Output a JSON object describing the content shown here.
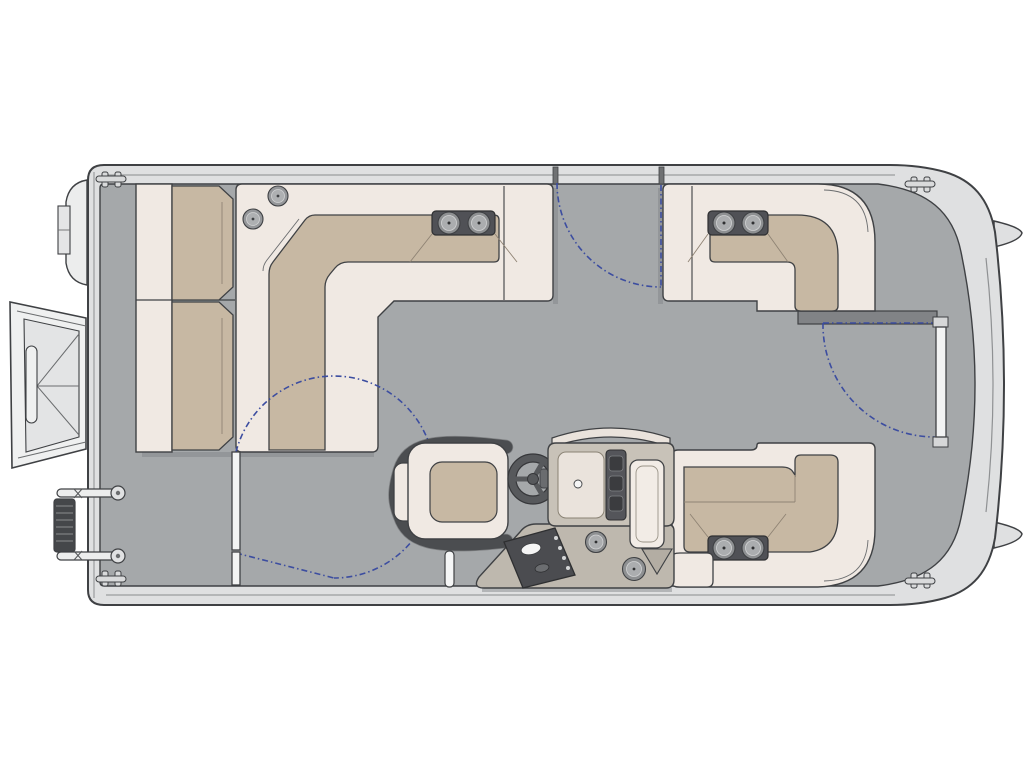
{
  "diagram": {
    "type": "pontoon-boat-floorplan",
    "view": "top-down",
    "orientation": "bow-right-stern-left",
    "components": [
      {
        "name": "hull",
        "label": "pontoon deck hull"
      },
      {
        "name": "stern-bench",
        "label": "stern bench seat, two cushions"
      },
      {
        "name": "port-stern-lounge",
        "label": "L-shaped lounge, port stern"
      },
      {
        "name": "port-bow-lounge",
        "label": "L-shaped lounge, port bow"
      },
      {
        "name": "starboard-bow-lounge",
        "label": "L-shaped chaise lounge, starboard bow"
      },
      {
        "name": "captain-chair",
        "label": "helm captain chair"
      },
      {
        "name": "steering-wheel",
        "label": "steering wheel"
      },
      {
        "name": "helm-console",
        "label": "helm console with windshield, gauges, switch panel"
      },
      {
        "name": "outboard-motor",
        "label": "outboard motor, stern"
      },
      {
        "name": "boarding-ladder",
        "label": "stowed boarding ladder, stern"
      },
      {
        "name": "tow-pylon",
        "label": "tow pylon post"
      },
      {
        "name": "bow-gate",
        "label": "bow entry gate with swing arc"
      },
      {
        "name": "port-gate",
        "label": "port side gate with swing arc"
      },
      {
        "name": "starboard-gate",
        "label": "starboard side gate with swing arc"
      }
    ],
    "counts": {
      "gates": 3,
      "cleats": 4,
      "cup_holders": 10,
      "armrest_modules": 3
    }
  },
  "colors": {
    "background": "#ffffff",
    "deck": "#a5a8aa",
    "hull_band": "#dfe0e1",
    "hull_light": "#eff0f0",
    "outline": "#3f4144",
    "seat_base": "#f0e9e3",
    "cushion": "#c7b8a3",
    "dark_accent": "#57595c",
    "module_dark": "#505156",
    "metal_ring": "#8e9092",
    "metal_inner": "#abadaf",
    "gate_swing": "#3c4da0",
    "shadow": "#7e8184",
    "console_body": "#c8c2b8",
    "console_tray": "#beb8ae",
    "kick_bar": "#818386",
    "dash_cream": "#eae3dc"
  }
}
